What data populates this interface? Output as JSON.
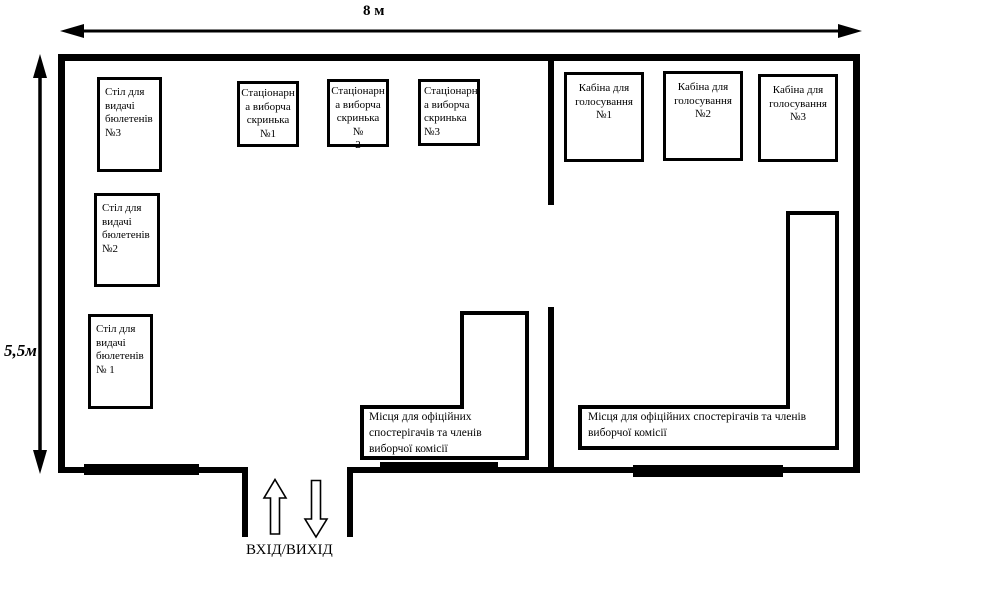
{
  "diagram": {
    "width_label": "8 м",
    "height_label": "5,5м",
    "entrance_label": "ВХІД/ВИХІД"
  },
  "left_room": {
    "table3": {
      "l1": "Стіл для",
      "l2": "видачі",
      "l3": "бюлетенів",
      "l4": "№3"
    },
    "table2": {
      "l1": "Стіл для",
      "l2": "видачі",
      "l3": "бюлетенів",
      "l4": "№2"
    },
    "table1": {
      "l1": "Стіл для",
      "l2": "видачі",
      "l3": "бюлетенів",
      "l4": "№ 1"
    },
    "ballot1": {
      "l1": "Стаціонарн",
      "l2": "а виборча",
      "l3": "скринька",
      "l4": "№1"
    },
    "ballot2": {
      "l1": "Стаціонарн",
      "l2": "а виборча",
      "l3": "скринька №",
      "l4": "2"
    },
    "ballot3": {
      "l1": "Стаціонарн",
      "l2": "а виборча",
      "l3": "скринька",
      "l4": "№3"
    },
    "observers": "Місця для офіційних спостерігачів та членів виборчої комісії"
  },
  "right_room": {
    "booth1": {
      "l1": "Кабіна для",
      "l2": "голосування",
      "l3": "№1"
    },
    "booth2": {
      "l1": "Кабіна для",
      "l2": "голосування",
      "l3": "№2"
    },
    "booth3": {
      "l1": "Кабіна для",
      "l2": "голосування",
      "l3": "№3"
    },
    "observers": "Місця для офіційних спостерігачів та членів виборчої комісії"
  },
  "colors": {
    "line": "#000000",
    "background": "#ffffff"
  }
}
